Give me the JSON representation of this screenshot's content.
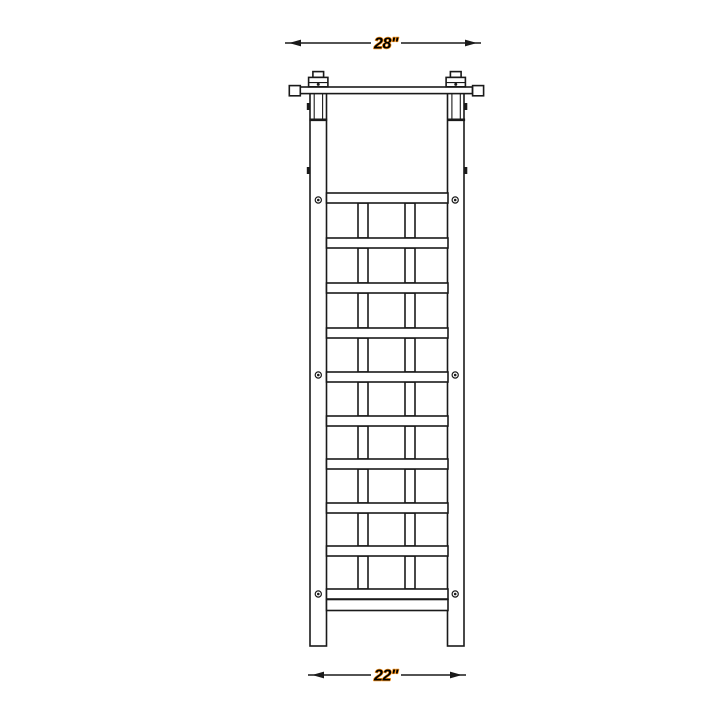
{
  "page": {
    "background_color": "#ffffff"
  },
  "drawing": {
    "type": "technical-line-drawing",
    "subject": "garden trellis front elevation",
    "stroke_color": "#1a1a1a",
    "fill_color": "#ffffff",
    "dimension_labels": {
      "top": "28\"",
      "bottom": "22\""
    },
    "dimension_label_style": {
      "text_color": "#000000",
      "halo_color": "#f7941d"
    },
    "lattice": {
      "rail_ys": [
        193,
        238,
        283,
        328,
        372,
        416,
        459,
        503,
        546,
        589
      ],
      "rail_height": 10,
      "rail_x1": 326.5,
      "rail_x2": 448,
      "slat_xs": [
        358,
        405
      ],
      "slat_width": 10,
      "bottom_stretcher": {
        "y": 599.5,
        "height": 11
      },
      "screw_ys": [
        200,
        375,
        594
      ],
      "screw_x_left": 318.3,
      "screw_x_right": 455.2
    }
  }
}
